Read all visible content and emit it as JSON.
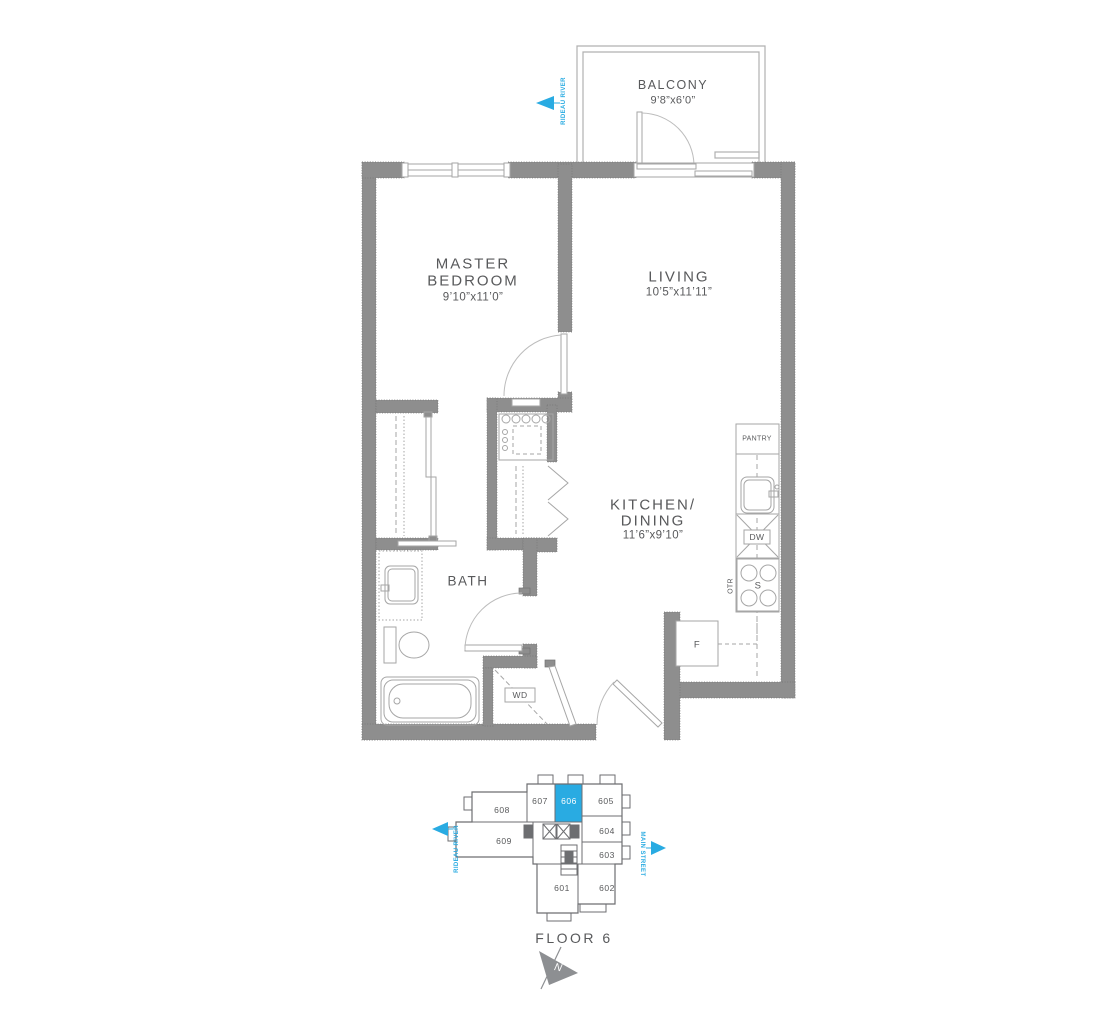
{
  "plan": {
    "balcony": {
      "label": "BALCONY",
      "dim": "9’8”x6’0”"
    },
    "master_bedroom": {
      "line1": "MASTER",
      "line2": "BEDROOM",
      "dim": "9’10”x11’0”"
    },
    "living": {
      "label": "LIVING",
      "dim": "10’5”x11’11”"
    },
    "kitchen_dining": {
      "line1": "KITCHEN/",
      "line2": "DINING",
      "dim": "11’6”x9’10”"
    },
    "bath": {
      "label": "BATH"
    },
    "fixtures": {
      "pantry": "PANTRY",
      "dishwasher": "DW",
      "stove": "S",
      "otr": "OTR",
      "fridge": "F",
      "washer_dryer": "WD"
    }
  },
  "key_plan": {
    "floor_label": "FLOOR 6",
    "north": "N",
    "highlighted_unit": "606",
    "units": [
      "601",
      "602",
      "603",
      "604",
      "605",
      "606",
      "607",
      "608",
      "609"
    ]
  },
  "orientation": {
    "rideau_river": "RIDEAU RIVER",
    "main_street": "MAIN STREET"
  },
  "colors": {
    "accent_blue": "#29abe2",
    "wall_gray": "#8e8e8e",
    "text_gray": "#58595b"
  }
}
